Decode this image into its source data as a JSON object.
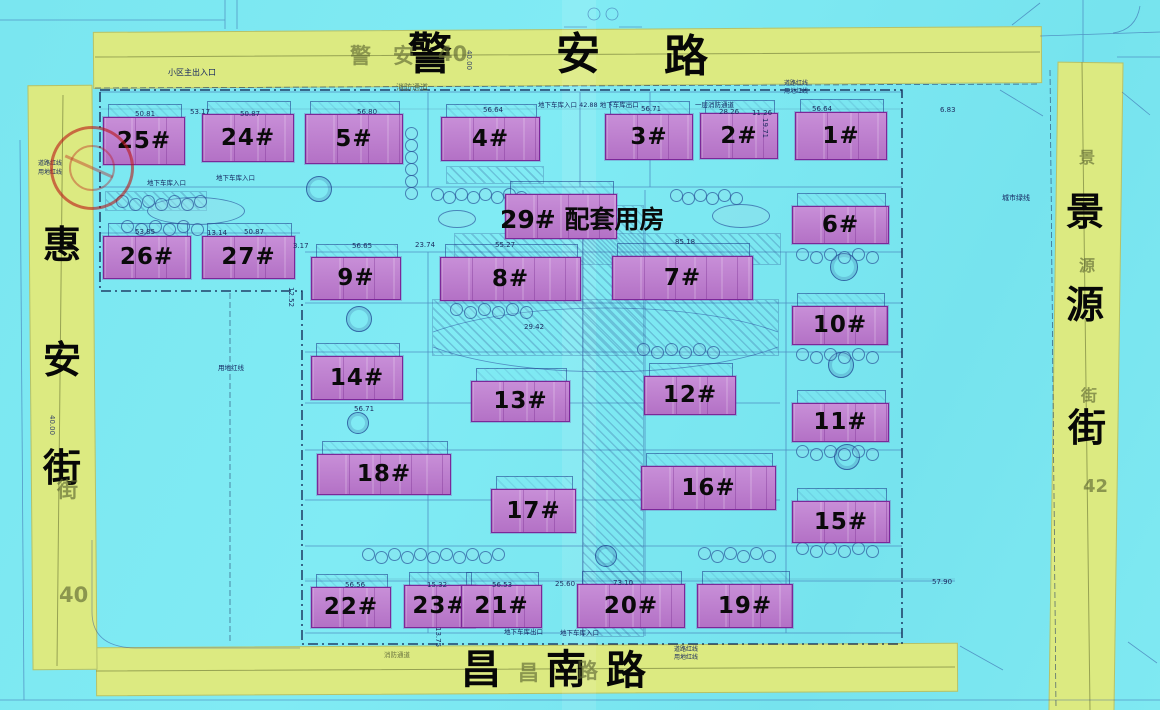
{
  "map_title": "residential-site-plan",
  "colors": {
    "background_cyan": "#7ae6f0",
    "road_yellow": "#dcea81",
    "building_pink": "#c07fd2",
    "building_border": "#7c2799",
    "linework_blue": "#2b4a9e",
    "boundary_dark": "#0e1e4e",
    "label_black": "#070707",
    "ghost_olive": "#5f6932",
    "stamp_red": "#ba1616"
  },
  "roads": {
    "top": {
      "name": "警安路",
      "chars": [
        {
          "t": "警",
          "x": 408,
          "y": 33
        },
        {
          "t": "安",
          "x": 556,
          "y": 33
        },
        {
          "t": "路",
          "x": 664,
          "y": 35
        }
      ],
      "ghosts": [
        {
          "t": "警",
          "x": 350,
          "y": 46
        },
        {
          "t": "安",
          "x": 393,
          "y": 46
        },
        {
          "t": "40",
          "x": 438,
          "y": 44
        }
      ],
      "dims": [
        {
          "t": "40.00",
          "x": 472,
          "y": 50,
          "rot": 90
        }
      ]
    },
    "bottom": {
      "name": "昌南路",
      "chars": [
        {
          "t": "昌",
          "x": 461,
          "y": 650
        },
        {
          "t": "南",
          "x": 546,
          "y": 650
        },
        {
          "t": "路",
          "x": 606,
          "y": 651
        }
      ],
      "ghosts": [
        {
          "t": "昌",
          "x": 518,
          "y": 663
        },
        {
          "t": "路",
          "x": 577,
          "y": 661
        }
      ],
      "dims": []
    },
    "left": {
      "name": "惠安街",
      "chars": [
        {
          "t": "惠",
          "x": 43,
          "y": 226
        },
        {
          "t": "安",
          "x": 43,
          "y": 341
        },
        {
          "t": "街",
          "x": 43,
          "y": 449
        }
      ],
      "ghosts": [
        {
          "t": "街",
          "x": 57,
          "y": 480
        },
        {
          "t": "40",
          "x": 59,
          "y": 585
        }
      ],
      "dims": [
        {
          "t": "40.00",
          "x": 55,
          "y": 415,
          "rot": 90
        }
      ]
    },
    "right": {
      "name": "景源街",
      "chars": [
        {
          "t": "景",
          "x": 1066,
          "y": 193
        },
        {
          "t": "源",
          "x": 1066,
          "y": 286
        },
        {
          "t": "街",
          "x": 1068,
          "y": 409
        }
      ],
      "ghosts": [
        {
          "t": "景",
          "x": 1079,
          "y": 150,
          "fs": 16
        },
        {
          "t": "源",
          "x": 1079,
          "y": 258,
          "fs": 16
        },
        {
          "t": "街",
          "x": 1081,
          "y": 388,
          "fs": 16
        },
        {
          "t": "42",
          "x": 1083,
          "y": 478,
          "fs": 18
        }
      ],
      "dims": []
    }
  },
  "buildings": [
    {
      "label": "1#",
      "x": 795,
      "y": 112,
      "w": 92,
      "h": 48
    },
    {
      "label": "2#",
      "x": 700,
      "y": 113,
      "w": 78,
      "h": 46
    },
    {
      "label": "3#",
      "x": 605,
      "y": 114,
      "w": 88,
      "h": 46
    },
    {
      "label": "4#",
      "x": 441,
      "y": 117,
      "w": 99,
      "h": 44
    },
    {
      "label": "5#",
      "x": 305,
      "y": 114,
      "w": 98,
      "h": 50
    },
    {
      "label": "24#",
      "x": 202,
      "y": 114,
      "w": 92,
      "h": 48
    },
    {
      "label": "25#",
      "x": 103,
      "y": 117,
      "w": 82,
      "h": 48
    },
    {
      "label": "26#",
      "x": 103,
      "y": 236,
      "w": 88,
      "h": 43
    },
    {
      "label": "27#",
      "x": 202,
      "y": 236,
      "w": 93,
      "h": 43
    },
    {
      "label": "",
      "x": 505,
      "y": 194,
      "w": 112,
      "h": 45,
      "id": "29"
    },
    {
      "label": "6#",
      "x": 792,
      "y": 206,
      "w": 97,
      "h": 38
    },
    {
      "label": "9#",
      "x": 311,
      "y": 257,
      "w": 90,
      "h": 43
    },
    {
      "label": "8#",
      "x": 440,
      "y": 257,
      "w": 141,
      "h": 44
    },
    {
      "label": "7#",
      "x": 612,
      "y": 256,
      "w": 141,
      "h": 44
    },
    {
      "label": "10#",
      "x": 792,
      "y": 306,
      "w": 96,
      "h": 39
    },
    {
      "label": "14#",
      "x": 311,
      "y": 356,
      "w": 92,
      "h": 44
    },
    {
      "label": "12#",
      "x": 644,
      "y": 376,
      "w": 92,
      "h": 39
    },
    {
      "label": "13#",
      "x": 471,
      "y": 381,
      "w": 99,
      "h": 41
    },
    {
      "label": "11#",
      "x": 792,
      "y": 403,
      "w": 97,
      "h": 39
    },
    {
      "label": "18#",
      "x": 317,
      "y": 454,
      "w": 134,
      "h": 41
    },
    {
      "label": "16#",
      "x": 641,
      "y": 466,
      "w": 135,
      "h": 44
    },
    {
      "label": "17#",
      "x": 491,
      "y": 489,
      "w": 85,
      "h": 44
    },
    {
      "label": "15#",
      "x": 792,
      "y": 501,
      "w": 98,
      "h": 42
    },
    {
      "label": "22#",
      "x": 311,
      "y": 587,
      "w": 80,
      "h": 41
    },
    {
      "label": "23#",
      "x": 404,
      "y": 585,
      "w": 71,
      "h": 43
    },
    {
      "label": "21#",
      "x": 461,
      "y": 585,
      "w": 81,
      "h": 43
    },
    {
      "label": "20#",
      "x": 577,
      "y": 584,
      "w": 108,
      "h": 44
    },
    {
      "label": "19#",
      "x": 697,
      "y": 584,
      "w": 96,
      "h": 44
    }
  ],
  "big_labels": [
    {
      "t": "29# 配套用房",
      "x": 500,
      "y": 207,
      "fs": 25,
      "bold": true
    }
  ],
  "annotations": [
    {
      "t": "小区主出入口",
      "x": 168,
      "y": 69
    },
    {
      "t": "消防通道",
      "x": 396,
      "y": 84,
      "c": "#5c6a49"
    },
    {
      "t": "地下车库入口 42.88 地下车库出口",
      "x": 538,
      "y": 102,
      "fs": 6.5
    },
    {
      "t": "一层消防通道",
      "x": 695,
      "y": 102,
      "fs": 6.5
    },
    {
      "t": "道路红线",
      "x": 784,
      "y": 81,
      "fs": 6
    },
    {
      "t": "用地红线",
      "x": 784,
      "y": 89,
      "fs": 6
    },
    {
      "t": "城市绿线",
      "x": 1002,
      "y": 195,
      "fs": 7
    },
    {
      "t": "道路红线",
      "x": 38,
      "y": 161,
      "fs": 6
    },
    {
      "t": "用地红线",
      "x": 38,
      "y": 170,
      "fs": 6
    },
    {
      "t": "地下车库入口",
      "x": 147,
      "y": 180,
      "fs": 6.5
    },
    {
      "t": "地下车库入口",
      "x": 216,
      "y": 175,
      "fs": 6.5
    },
    {
      "t": "用地红线",
      "x": 218,
      "y": 365,
      "fs": 6.5
    },
    {
      "t": "地下车库出口",
      "x": 504,
      "y": 629,
      "fs": 6.5
    },
    {
      "t": "地下车库入口",
      "x": 560,
      "y": 630,
      "fs": 6.5
    },
    {
      "t": "消防通道",
      "x": 384,
      "y": 652,
      "fs": 6.5,
      "c": "#6b7440"
    },
    {
      "t": "道路红线",
      "x": 674,
      "y": 647,
      "fs": 6
    },
    {
      "t": "用地红线",
      "x": 674,
      "y": 655,
      "fs": 6
    }
  ],
  "dimensions": [
    {
      "t": "50.81",
      "x": 135,
      "y": 111
    },
    {
      "t": "53.17",
      "x": 190,
      "y": 109
    },
    {
      "t": "50.87",
      "x": 240,
      "y": 111
    },
    {
      "t": "56.80",
      "x": 357,
      "y": 109
    },
    {
      "t": "56.64",
      "x": 483,
      "y": 107
    },
    {
      "t": "56.71",
      "x": 641,
      "y": 106
    },
    {
      "t": "28.26",
      "x": 719,
      "y": 109
    },
    {
      "t": "11.26",
      "x": 752,
      "y": 110
    },
    {
      "t": "56.64",
      "x": 812,
      "y": 106
    },
    {
      "t": "6.83",
      "x": 940,
      "y": 107
    },
    {
      "t": "19.71",
      "x": 768,
      "y": 118,
      "rot": 90
    },
    {
      "t": "53.85",
      "x": 135,
      "y": 229
    },
    {
      "t": "13.14",
      "x": 207,
      "y": 230
    },
    {
      "t": "50.87",
      "x": 244,
      "y": 229
    },
    {
      "t": "3.17",
      "x": 293,
      "y": 243
    },
    {
      "t": "56.65",
      "x": 352,
      "y": 243
    },
    {
      "t": "23.74",
      "x": 415,
      "y": 242
    },
    {
      "t": "55.27",
      "x": 495,
      "y": 242
    },
    {
      "t": "85.18",
      "x": 675,
      "y": 239
    },
    {
      "t": "29.42",
      "x": 524,
      "y": 324
    },
    {
      "t": "12.52",
      "x": 294,
      "y": 287,
      "rot": 90
    },
    {
      "t": "56.71",
      "x": 354,
      "y": 406
    },
    {
      "t": "56.56",
      "x": 345,
      "y": 582
    },
    {
      "t": "15.32",
      "x": 427,
      "y": 582
    },
    {
      "t": "56.53",
      "x": 492,
      "y": 582
    },
    {
      "t": "25.60",
      "x": 555,
      "y": 581
    },
    {
      "t": "73.10",
      "x": 613,
      "y": 580
    },
    {
      "t": "57.90",
      "x": 932,
      "y": 579
    },
    {
      "t": "13.75",
      "x": 441,
      "y": 627,
      "rot": 90
    }
  ],
  "landscape": {
    "tree_rows": [
      [
        116,
        195,
        7,
        13,
        0
      ],
      [
        121,
        220,
        6,
        14,
        0
      ],
      [
        405,
        127,
        6,
        0,
        12
      ],
      [
        431,
        188,
        8,
        12,
        0
      ],
      [
        450,
        303,
        6,
        14,
        0
      ],
      [
        637,
        343,
        6,
        14,
        0
      ],
      [
        362,
        548,
        11,
        13,
        0
      ],
      [
        796,
        248,
        6,
        14,
        0
      ],
      [
        796,
        348,
        6,
        14,
        0
      ],
      [
        796,
        445,
        6,
        14,
        0
      ],
      [
        796,
        542,
        6,
        14,
        0
      ],
      [
        516,
        212,
        5,
        13,
        0
      ],
      [
        670,
        189,
        6,
        12,
        0
      ],
      [
        698,
        547,
        6,
        13,
        0
      ]
    ],
    "ponds": [
      [
        147,
        197,
        96,
        26
      ],
      [
        438,
        210,
        36,
        16
      ],
      [
        712,
        204,
        56,
        22
      ]
    ],
    "pavilions": [
      [
        306,
        176,
        24
      ],
      [
        346,
        306,
        24
      ],
      [
        347,
        412,
        20
      ],
      [
        595,
        545,
        20
      ],
      [
        830,
        253,
        26
      ],
      [
        828,
        352,
        24
      ],
      [
        834,
        444,
        24
      ]
    ],
    "hatches": [
      [
        447,
        167,
        96,
        16
      ],
      [
        455,
        234,
        325,
        30
      ],
      [
        583,
        206,
        60,
        430
      ],
      [
        433,
        300,
        345,
        55
      ],
      [
        106,
        192,
        100,
        18
      ]
    ]
  }
}
